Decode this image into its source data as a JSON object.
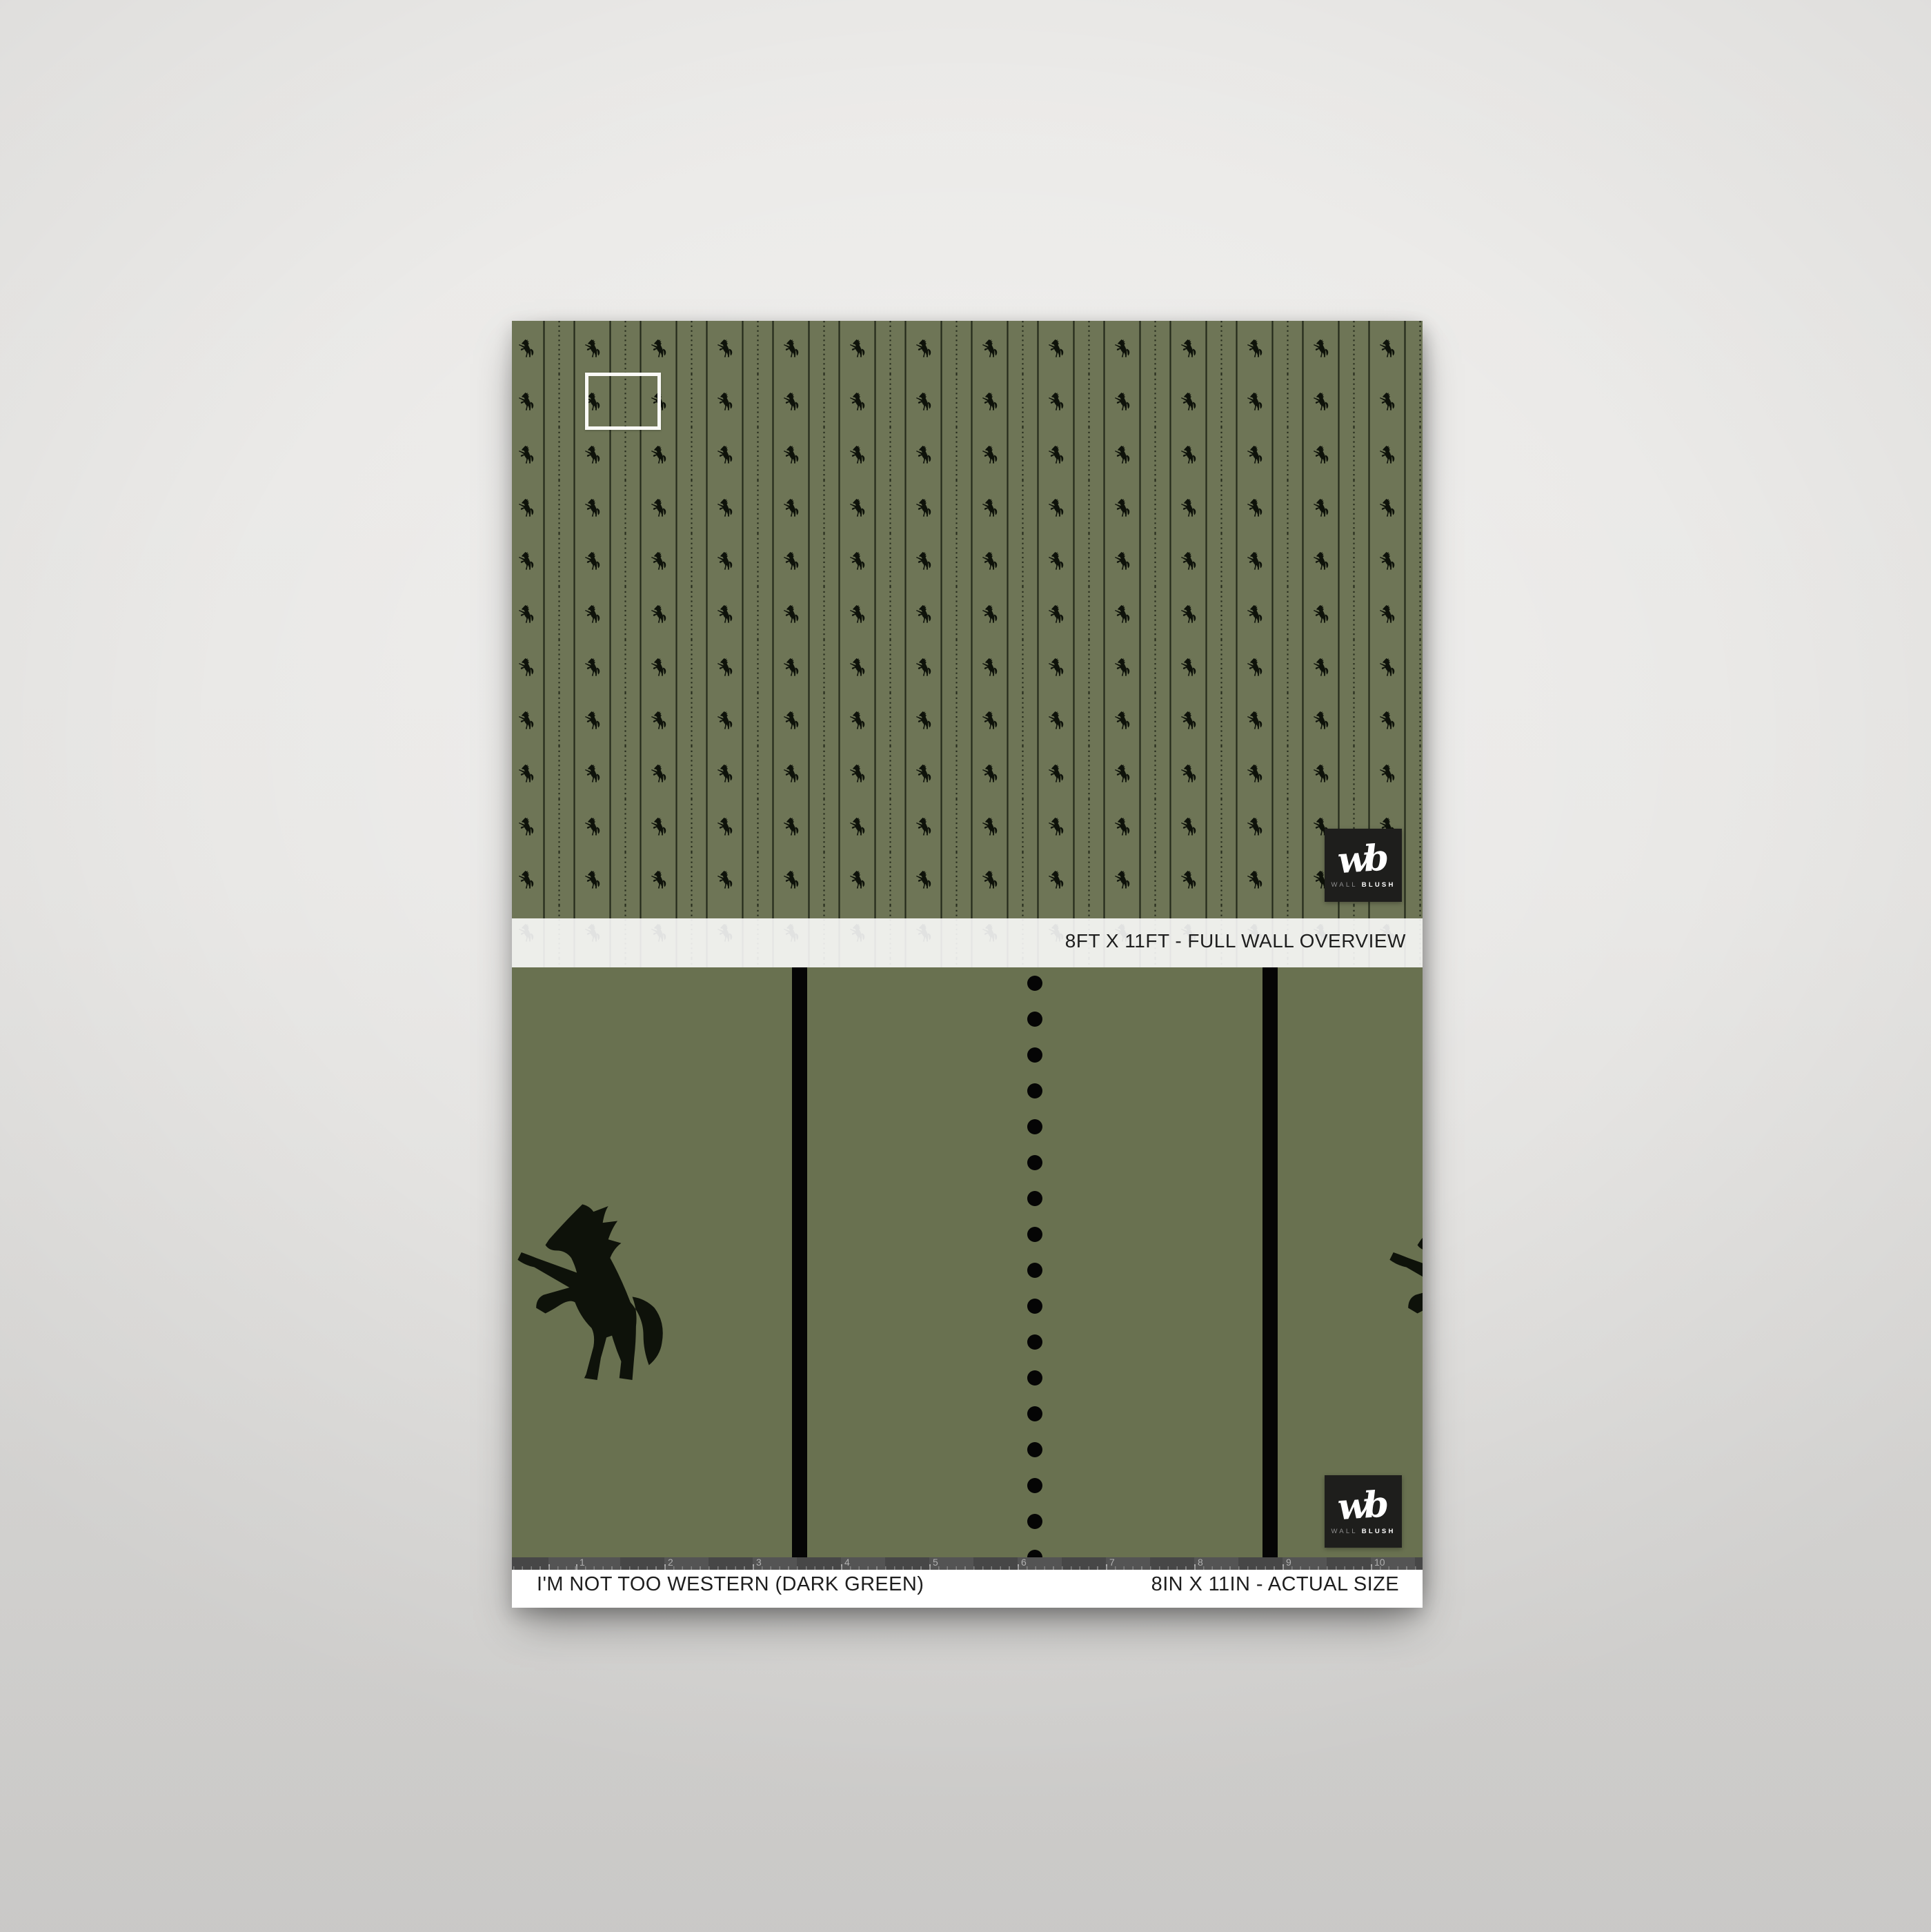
{
  "poster": {
    "wall_overview_label": "8FT X 11FT - FULL WALL OVERVIEW",
    "product_title": "I'M NOT TOO WESTERN (DARK GREEN)",
    "actual_size_label": "8IN X 11IN - ACTUAL SIZE",
    "brand": {
      "monogram": "wb",
      "word_1": "WALL",
      "word_2": "BLUSH"
    },
    "ruler_numbers": [
      "1",
      "2",
      "3",
      "4",
      "5",
      "6",
      "7",
      "8",
      "9",
      "10"
    ],
    "icons": {
      "pattern_motif": "rearing-horse-silhouette",
      "sample_marker": "sample-area-outline"
    },
    "colors": {
      "green_wall": "#6e7556",
      "green_sample": "#697150",
      "pattern_line": "#242a1b",
      "horse_black": "#0e120a",
      "ruler_bg": "#4b4b4b",
      "ruler_text": "#b0b0b0",
      "label_text": "#1e1e1e",
      "logo_bg": "#1e1e1c",
      "white": "#ffffff"
    }
  }
}
